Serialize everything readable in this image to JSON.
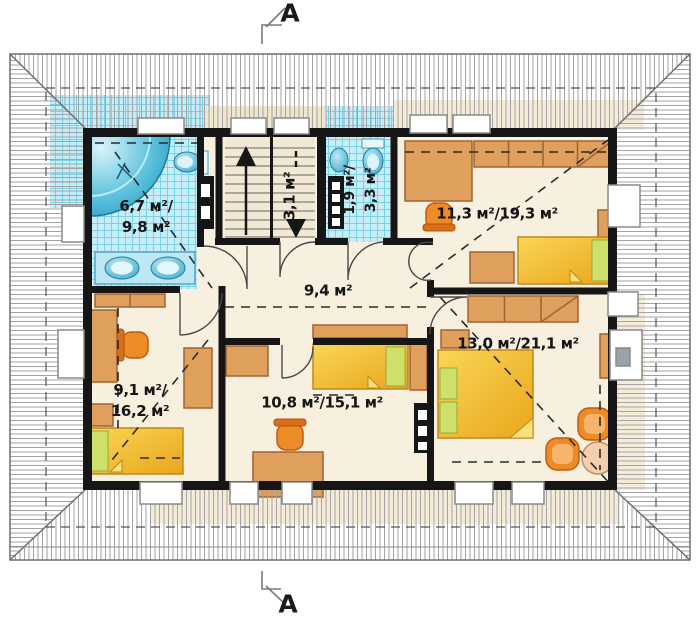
{
  "section": {
    "top_label": "A",
    "bottom_label": "A"
  },
  "rooms": {
    "bathroom": {
      "area_line1": "6,7 м²/",
      "area_line2": "9,8 м²"
    },
    "staircase": {
      "area": "3,1 м²"
    },
    "wc": {
      "area_line1": "1,9 м²/",
      "area_line2": "3,3 м²"
    },
    "bedroom_top_right": {
      "area": "11,3 м²/19,3 м²"
    },
    "hall": {
      "area": "9,4 м²"
    },
    "bedroom_right": {
      "area": "13,0 м²/21,1 м²"
    },
    "bedroom_bottom_left": {
      "area_line1": "9,1 м²/",
      "area_line2": "16,2 м²"
    },
    "bedroom_bottom_middle": {
      "area": "10,8 м²/15,1 м²"
    }
  },
  "colors": {
    "floor": "#f8f0df",
    "tile": "#c9edf7",
    "tile_line": "#79d2e6",
    "wall": "#161616",
    "furniture": "#dfa05d",
    "bed": "#f2b52f",
    "pillow": "#cfe06a",
    "fixture": "#35aed0",
    "hatch": "#a3a3a3"
  }
}
